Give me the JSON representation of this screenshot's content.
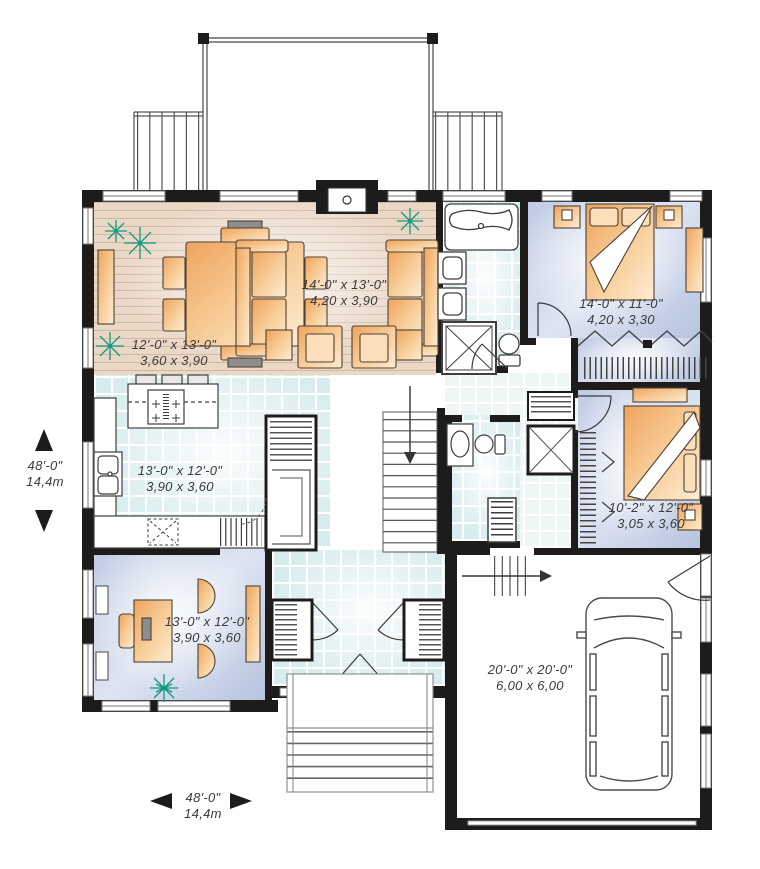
{
  "rooms": {
    "living": {
      "imperial": "14'-0\" x 13'-0\"",
      "metric": "4,20 x 3,90"
    },
    "dining": {
      "imperial": "12'-0\" x 13'-0\"",
      "metric": "3,60 x 3,90"
    },
    "kitchen": {
      "imperial": "13'-0\" x 12'-0\"",
      "metric": "3,90 x 3,60"
    },
    "office": {
      "imperial": "13'-0\" x 12'-0\"",
      "metric": "3,90 x 3,60"
    },
    "master_bedroom": {
      "imperial": "14'-0\" x 11'-0\"",
      "metric": "4,20 x 3,30"
    },
    "bedroom_2": {
      "imperial": "10'-2\" x 12'-0\"",
      "metric": "3,05 x 3,60"
    },
    "garage": {
      "imperial": "20'-0\" x 20'-0\"",
      "metric": "6,00 x 6,00"
    }
  },
  "overall_dimensions": {
    "left": {
      "imperial": "48'-0\"",
      "metric": "14,4m"
    },
    "bottom": {
      "imperial": "48'-0\"",
      "metric": "14,4m"
    }
  },
  "colors": {
    "wall": "#1d1c1a",
    "wood_floor": "#ead8c7",
    "tile_floor": "#d7ecee",
    "carpet_floor": "#c4cfe6",
    "furniture": "#f5bc7d",
    "plant": "#13977e",
    "text": "#3a3a3a"
  }
}
